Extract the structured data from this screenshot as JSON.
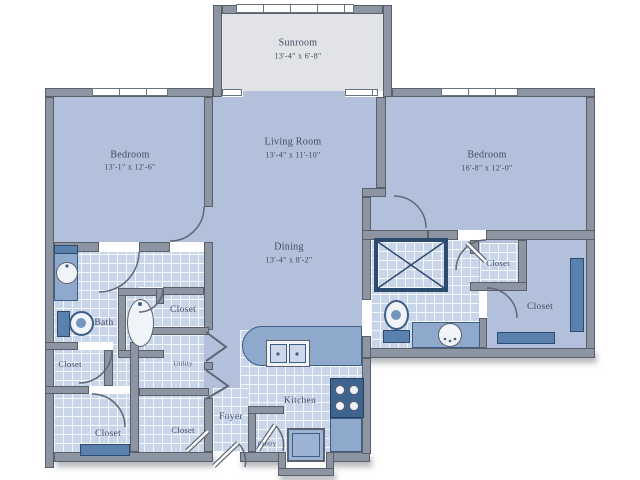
{
  "floorplan": {
    "rooms": {
      "sunroom": {
        "name": "Sunroom",
        "dims": "13'-4\" x 6'-8\""
      },
      "bedroom_left": {
        "name": "Bedroom",
        "dims": "13'-1\" x 12'-6\""
      },
      "living_room": {
        "name": "Living Room",
        "dims": "13'-4\" x 11'-10\""
      },
      "bedroom_right": {
        "name": "Bedroom",
        "dims": "16'-8\" x 12'-0\""
      },
      "dining": {
        "name": "Dining",
        "dims": "13'-4\" x 8'-2\""
      }
    },
    "areas": {
      "bath": "Bath",
      "kitchen": "Kitchen",
      "foyer": "Foyer",
      "pantry": "Pantry",
      "utility": "Utility",
      "closet": "Closet"
    },
    "colors": {
      "wall": "#8d95a2",
      "wall_outline": "#596069",
      "carpet": "#b3c0db",
      "tile": "#c9d5e8",
      "sunroom_floor": "#e1e3e7",
      "fixture": "#8fa9cc",
      "fixture_dark": "#5a81ad",
      "stove": "#3f648f",
      "text": "#3d4b61"
    }
  }
}
